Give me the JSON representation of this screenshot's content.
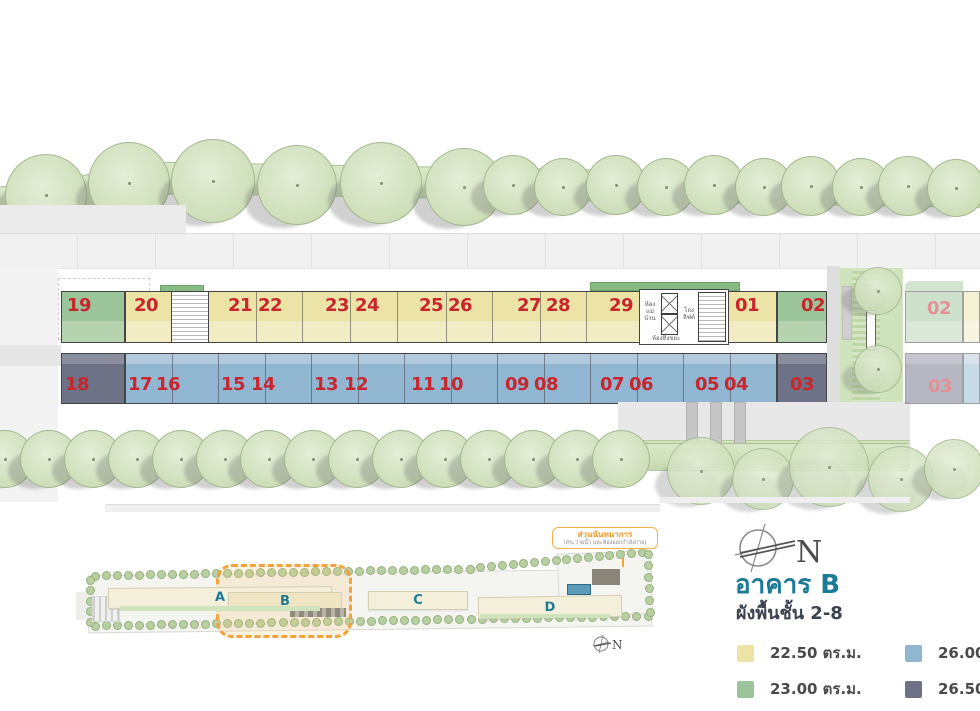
{
  "info": {
    "title": "อาคาร B",
    "subtitle": "ผังพื้นชั้น 2-8",
    "compass_label": "N",
    "legend": [
      {
        "label": "22.50 ตร.ม.",
        "color": "#ebe4a6",
        "key": "yellow"
      },
      {
        "label": "26.00 ตร.ม.",
        "color": "#91b6d2",
        "key": "blue"
      },
      {
        "label": "23.00 ตร.ม.",
        "color": "#9cc49b",
        "key": "green"
      },
      {
        "label": "26.50 ตร.ม.",
        "color": "#6e7287",
        "key": "slate"
      }
    ]
  },
  "floor_plan": {
    "top_units": [
      {
        "no": "19",
        "type": "green"
      },
      {
        "no": "20",
        "type": "yellow"
      },
      {
        "no": "21",
        "type": "yellow"
      },
      {
        "no": "22",
        "type": "yellow"
      },
      {
        "no": "23",
        "type": "yellow"
      },
      {
        "no": "24",
        "type": "yellow"
      },
      {
        "no": "25",
        "type": "yellow"
      },
      {
        "no": "26",
        "type": "yellow"
      },
      {
        "no": "27",
        "type": "yellow"
      },
      {
        "no": "28",
        "type": "yellow"
      },
      {
        "no": "29",
        "type": "yellow"
      },
      {
        "no": "01",
        "type": "yellow"
      },
      {
        "no": "02",
        "type": "green"
      }
    ],
    "bottom_units": [
      {
        "no": "18",
        "type": "slate"
      },
      {
        "no": "17",
        "type": "blue"
      },
      {
        "no": "16",
        "type": "blue"
      },
      {
        "no": "15",
        "type": "blue"
      },
      {
        "no": "14",
        "type": "blue"
      },
      {
        "no": "13",
        "type": "blue"
      },
      {
        "no": "12",
        "type": "blue"
      },
      {
        "no": "11",
        "type": "blue"
      },
      {
        "no": "10",
        "type": "blue"
      },
      {
        "no": "09",
        "type": "blue"
      },
      {
        "no": "08",
        "type": "blue"
      },
      {
        "no": "07",
        "type": "blue"
      },
      {
        "no": "06",
        "type": "blue"
      },
      {
        "no": "05",
        "type": "blue"
      },
      {
        "no": "04",
        "type": "blue"
      },
      {
        "no": "03",
        "type": "slate"
      }
    ],
    "adjacent_building_units": [
      {
        "no": "02",
        "type": "green"
      },
      {
        "no": "03",
        "type": "slate"
      }
    ],
    "core": {
      "maid_room": "ห้องแม่บ้าน",
      "lift_lobby": "โถงลิฟต์",
      "garbage_room": "ห้องทิ้งขยะ"
    }
  },
  "site_plan": {
    "buildings": [
      {
        "label": "A",
        "highlighted": false
      },
      {
        "label": "B",
        "highlighted": true
      },
      {
        "label": "C",
        "highlighted": false
      },
      {
        "label": "D",
        "highlighted": false
      }
    ],
    "annotation": {
      "title": "ส่วนนันทนาการ",
      "subtitle": "(สระว่ายน้ำ และห้องออกกำลังกาย)"
    },
    "compass_label": "N"
  },
  "colors": {
    "unit_number": "#c9252c",
    "accent_teal": "#1b7b97",
    "highlight_orange": "#f2a33c"
  }
}
